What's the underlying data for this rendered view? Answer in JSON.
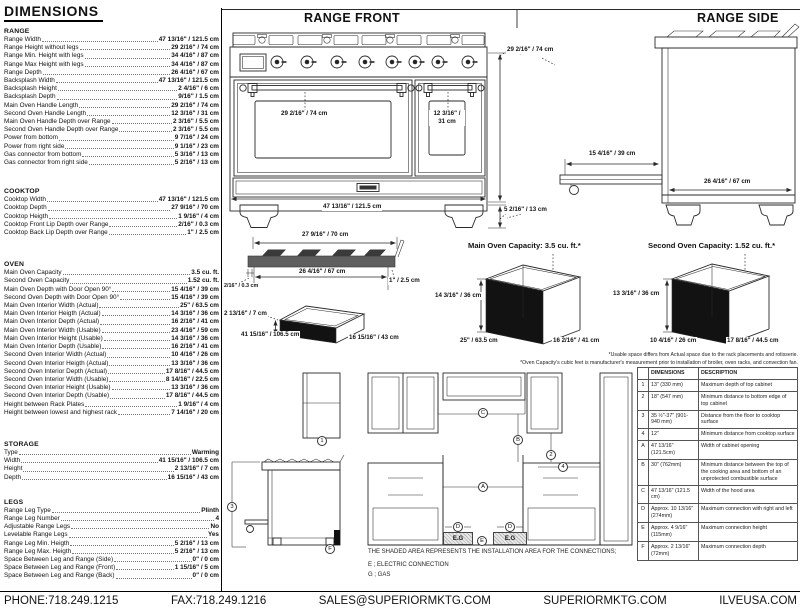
{
  "page": {
    "title": "DIMENSIONS"
  },
  "sheet": {
    "front_title": "RANGE FRONT",
    "side_title": "RANGE SIDE"
  },
  "specs": {
    "range": {
      "title": "RANGE",
      "rows": [
        {
          "label": "Range Width",
          "value": "47 13/16\" / 121.5 cm"
        },
        {
          "label": "Range Height without legs",
          "value": "29 2/16\" / 74 cm"
        },
        {
          "label": "Range Min. Height with legs",
          "value": "34 4/16\" / 87 cm"
        },
        {
          "label": "Range Max Height with legs",
          "value": "34 4/16\" / 87 cm"
        },
        {
          "label": "Range Depth",
          "value": "26 4/16\" / 67 cm"
        },
        {
          "label": "Backsplash Width",
          "value": "47 13/16\" / 121.5 cm"
        },
        {
          "label": "Backsplash Height",
          "value": "2 4/16\" / 6 cm"
        },
        {
          "label": "Backsplash Depth",
          "value": "9/16\" / 1.5 cm"
        },
        {
          "label": "Main Oven Handle Length",
          "value": "29 2/16\" / 74 cm"
        },
        {
          "label": "Second Oven Handle Length",
          "value": "12 3/16\" / 31 cm"
        },
        {
          "label": "Main Oven Handle Depth over Range",
          "value": "2 3/16\" / 5.5 cm"
        },
        {
          "label": "Second Oven Handle Depth over Range",
          "value": "2 3/16\" / 5.5 cm"
        },
        {
          "label": "Power from bottom",
          "value": "9 7/16\" / 24 cm"
        },
        {
          "label": "Power from right side",
          "value": "9 1/16\" / 23 cm"
        },
        {
          "label": "Gas connector from bottom",
          "value": "5 3/16\" / 13 cm"
        },
        {
          "label": "Gas connector from right side",
          "value": "5 2/16\" / 13 cm"
        }
      ]
    },
    "cooktop": {
      "title": "COOKTOP",
      "rows": [
        {
          "label": "Cooktop Width",
          "value": "47 13/16\" / 121.5 cm"
        },
        {
          "label": "Cooktop Depth",
          "value": "27 9/16\" / 70 cm"
        },
        {
          "label": "Cooktop Heigth",
          "value": "1 9/16\" / 4 cm"
        },
        {
          "label": "Cooktop Front Lip Depth over Range",
          "value": "2/16\" / 0.3 cm"
        },
        {
          "label": "Cooktop Back Lip Depth over Range",
          "value": "1\" / 2.5 cm"
        }
      ]
    },
    "oven": {
      "title": "OVEN",
      "rows": [
        {
          "label": "Main Oven Capacity",
          "value": "3.5 cu. ft."
        },
        {
          "label": "Second Oven Capacity",
          "value": "1.52 cu. ft."
        },
        {
          "label": "Main Oven Depth with Door Open 90°",
          "value": "15 4/16\" / 39 cm"
        },
        {
          "label": "Second Oven Depth with Door Open 90°",
          "value": "15 4/16\" / 39 cm"
        },
        {
          "label": "Main Oven Interior Width (Actual)",
          "value": "25\" / 63.5 cm"
        },
        {
          "label": "Main Oven Interior Heigth (Actual)",
          "value": "14 3/16\" / 36 cm"
        },
        {
          "label": "Main Oven Interior Depth (Actual)",
          "value": "16 2/16\" / 41 cm"
        },
        {
          "label": "Main Oven Interior Width (Usable)",
          "value": "23 4/16\" / 59 cm"
        },
        {
          "label": "Main Oven Interior Height (Usable)",
          "value": "14 3/16\" / 36 cm"
        },
        {
          "label": "Main Oven Interior Depth (Usable)",
          "value": "16 2/16\" / 41 cm"
        },
        {
          "label": "Second Oven Interior Width (Actual)",
          "value": "10 4/16\" / 26 cm"
        },
        {
          "label": "Second Oven Interior Heigth (Actual)",
          "value": "13 3/16\" / 36 cm"
        },
        {
          "label": "Second Oven Interior Depth (Actual)",
          "value": "17 8/16\" / 44.5 cm"
        },
        {
          "label": "Second Oven Interior Width (Usable)",
          "value": "8 14/16\" / 22.5 cm"
        },
        {
          "label": "Second Oven Interior Height (Usable)",
          "value": "13 3/16\" / 36 cm"
        },
        {
          "label": "Second Oven Interior Depth (Usable)",
          "value": "17 8/16\" / 44.5 cm"
        },
        {
          "label": "Height between Rack Plates",
          "value": "1 9/16\" / 4 cm"
        },
        {
          "label": "Height between lowest and highest rack",
          "value": "7 14/16\" / 20 cm"
        }
      ]
    },
    "storage": {
      "title": "STORAGE",
      "rows": [
        {
          "label": "Type",
          "value": "Warming"
        },
        {
          "label": "Width",
          "value": "41 15/16\" / 106.5 cm"
        },
        {
          "label": "Height",
          "value": "2 13/16\" / 7 cm"
        },
        {
          "label": "Depth",
          "value": "16 15/16\" / 43 cm"
        }
      ]
    },
    "legs": {
      "title": "LEGS",
      "rows": [
        {
          "label": "Range Leg Type",
          "value": "Plinth"
        },
        {
          "label": "Range Leg Number",
          "value": "4"
        },
        {
          "label": "Adjustable Range Legs",
          "value": "No"
        },
        {
          "label": "Levelable Range Legs",
          "value": "Yes"
        },
        {
          "label": "Range Leg Min. Heigth",
          "value": "5 2/16\" / 13 cm"
        },
        {
          "label": "Range Leg Max. Heigth",
          "value": "5 2/16\" / 13 cm"
        },
        {
          "label": "Space Between Leg and Range (Side)",
          "value": "0\" / 0 cm"
        },
        {
          "label": "Space Between Leg and Range (Front)",
          "value": "1 15/16\" / 5 cm"
        },
        {
          "label": "Space Between Leg and Range (Back)",
          "value": "0\" / 0 cm"
        }
      ]
    }
  },
  "range_front": {
    "height": "29 2/16\" / 74 cm",
    "width": "47 13/16\" / 121.5 cm",
    "legs": "5 2/16\" / 13 cm",
    "main_handle": "29 2/16\" / 74 cm",
    "second_handle_a": "12 3/16\" /",
    "second_handle_b": "31 cm"
  },
  "range_side": {
    "door_open": "15 4/16\" / 39 cm",
    "depth": "26 4/16\" / 67 cm"
  },
  "cooktop_view": {
    "width": "27 9/16\" / 70 cm",
    "inner_width": "26 4/16\" / 67 cm",
    "back_lip": "1\" / 2.5 cm",
    "front_lip": "2/16\" / 0.3 cm"
  },
  "storage_view": {
    "height": "2 13/16\" / 7 cm",
    "width": "41 15/16\" / 106.5 cm",
    "depth": "16 15/16\" / 43 cm"
  },
  "main_oven_view": {
    "title": "Main Oven Capacity: 3.5 cu. ft.*",
    "height": "14 3/16\" / 36 cm",
    "width": "25\" / 63.5 cm",
    "depth": "16 2/16\" / 41 cm"
  },
  "second_oven_view": {
    "title": "Second Oven Capacity: 1.52 cu. ft.*",
    "height": "13 3/16\" / 36 cm",
    "width": "10 4/16\" / 26 cm",
    "depth": "17 8/16\" / 44.5 cm"
  },
  "footnotes": {
    "line1": "*Usable space differs from Actual space due to the rack placements and rotisserie.",
    "line2": "*Oven Capacity's cubic feet is manufacturer's measurement prior to installation of broiler, oven racks, and convection fan."
  },
  "install": {
    "note": "THE SHADED AREA REPRESENTS THE INSTALLATION AREA FOR THE CONNECTIONS;",
    "electric": "E ; ELECTRIC CONNECTION",
    "gas": "G ; GAS",
    "eg": "E.G",
    "callouts": {
      "n1": "1",
      "n2": "2",
      "n3": "3",
      "n4": "4",
      "a": "A",
      "b": "B",
      "c": "C",
      "d": "D",
      "e": "E",
      "f": "F"
    }
  },
  "table": {
    "headers": [
      "",
      "DIMENSIONS",
      "DESCRIPTION"
    ],
    "rows": [
      [
        "1",
        "13\" (330 mm)",
        "Maximum depth of top cabinet"
      ],
      [
        "2",
        "18\" (547 mm)",
        "Minimum distance to bottom edge of top cabinet"
      ],
      [
        "3",
        "35 ½\"-37\" (901-940 mm)",
        "Distance from the floor to cooktop surface"
      ],
      [
        "4",
        "12\"",
        "Minimum distance from cooktop surface"
      ],
      [
        "A",
        "47 13/16\" (121.5cm)",
        "Width of cabinet opening"
      ],
      [
        "B",
        "30\" (762mm)",
        "Minimum distance between the top of the cooking area and bottom of an unprotected combustible surface"
      ],
      [
        "C",
        "47 13/16\" (121.5 cm)",
        "Width of the hood area"
      ],
      [
        "D",
        "Approx. 10 13/16\" (274mm)",
        "Maximum connection with right and left"
      ],
      [
        "E",
        "Approx. 4 9/16\" (115mm)",
        "Maximum connection height"
      ],
      [
        "F",
        "Approx. 2 13/16\" (72mm)",
        "Maximum connection depth"
      ]
    ]
  },
  "footer": {
    "items": [
      "PHONE:718.249.1215",
      "FAX:718.249.1216",
      "SALES@SUPERIORMKTG.COM",
      "SUPERIORMKTG.COM",
      "ILVEUSA.COM"
    ]
  }
}
